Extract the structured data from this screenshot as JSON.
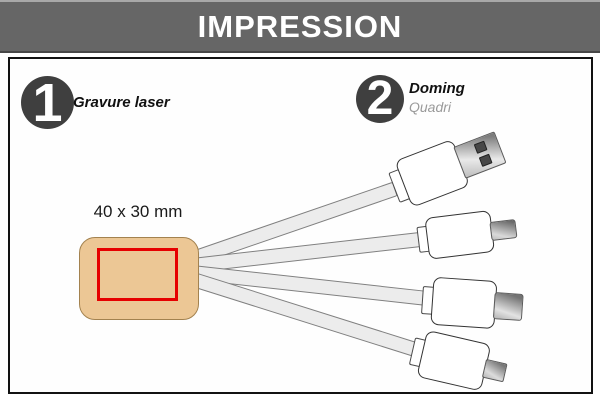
{
  "header": {
    "title": "IMPRESSION"
  },
  "steps": [
    {
      "number": "1",
      "label": "Gravure laser"
    },
    {
      "number": "2",
      "label": "Doming",
      "sublabel": "Quadri"
    }
  ],
  "print_area": {
    "dimensions": "40 x 30 mm"
  },
  "product": {
    "depicted": "4-in-1 charging cable",
    "connector_icons": [
      "usb-a-connector",
      "lightning-connector",
      "usb-c-connector",
      "micro-usb-connector"
    ]
  },
  "colors": {
    "header_gray": "#666666",
    "step_circle_dark": "#3f3f3f",
    "body_tan": "#ecc795",
    "print_zone_red": "#e60000",
    "cable_gray": "#ececec"
  }
}
